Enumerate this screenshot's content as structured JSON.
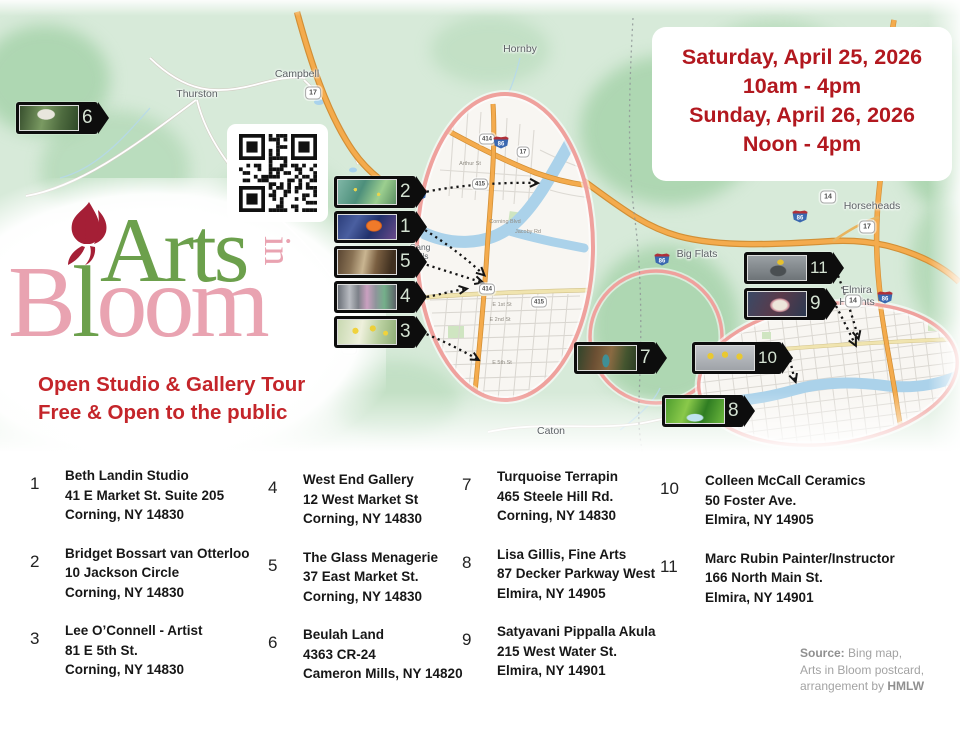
{
  "event": {
    "line1": "Saturday, April 25, 2026",
    "line2": "10am - 4pm",
    "line3": "Sunday, April 26, 2026",
    "line4": "Noon - 4pm"
  },
  "logo": {
    "arts": "Arts",
    "in": "in",
    "bloom_b": "B",
    "bloom_l": "l",
    "bloom_oom": "oom"
  },
  "tagline": {
    "line1": "Open Studio & Gallery Tour",
    "line2": "Free & Open to the public"
  },
  "map": {
    "towns": {
      "thurston": "Thurston",
      "campbell": "Campbell",
      "hornby": "Hornby",
      "caton": "Caton",
      "big_flats": "Big Flats",
      "horseheads": "Horseheads",
      "elmira_heights_line1": "Elmira",
      "elmira_heights_line2": "Heights",
      "gang_mills_line1": "Gang",
      "gang_mills_line2": "Mills"
    },
    "route_shields": [
      "17",
      "15",
      "14",
      "17",
      "14",
      "414",
      "17",
      "415",
      "414",
      "415"
    ],
    "interstate": "86",
    "streets": [
      "Arthur St",
      "Corning Blvd",
      "Jacoby Rd",
      "E 1st St",
      "E 2nd St",
      "E 5th St"
    ],
    "markers": [
      {
        "number": "1",
        "photo": "koi-fish-painting"
      },
      {
        "number": "2",
        "photo": "landscape-painting"
      },
      {
        "number": "3",
        "photo": "daffodil-painting"
      },
      {
        "number": "4",
        "photo": "gallery-storefront"
      },
      {
        "number": "5",
        "photo": "glass-horn-sculpture"
      },
      {
        "number": "6",
        "photo": "house-and-garden"
      },
      {
        "number": "7",
        "photo": "wooden-cabin"
      },
      {
        "number": "8",
        "photo": "green-landscape-painting"
      },
      {
        "number": "9",
        "photo": "lily-flower"
      },
      {
        "number": "10",
        "photo": "daffodils-in-vases"
      },
      {
        "number": "11",
        "photo": "sculpture-with-lemon"
      }
    ]
  },
  "directory": {
    "entries": [
      {
        "num": "1",
        "name": "Beth Landin Studio",
        "address": "41 E Market St. Suite 205",
        "city": "Corning, NY 14830"
      },
      {
        "num": "2",
        "name": "Bridget Bossart van Otterloo",
        "address": "10 Jackson Circle",
        "city": "Corning, NY 14830"
      },
      {
        "num": "3",
        "name": "Lee O’Connell - Artist",
        "address": "81 E 5th St.",
        "city": "Corning, NY 14830"
      },
      {
        "num": "4",
        "name": "West End Gallery",
        "address": "12 West Market St",
        "city": "Corning, NY 14830"
      },
      {
        "num": "5",
        "name": "The Glass Menagerie",
        "address": "37 East Market St.",
        "city": "Corning, NY 14830"
      },
      {
        "num": "6",
        "name": "Beulah Land",
        "address": "4363 CR-24",
        "city": "Cameron  Mills, NY 14820"
      },
      {
        "num": "7",
        "name": "Turquoise Terrapin",
        "address": "465 Steele Hill Rd.",
        "city": "Corning, NY 14830"
      },
      {
        "num": "8",
        "name": "Lisa Gillis, Fine Arts",
        "address": "87 Decker Parkway West",
        "city": "Elmira, NY 14905"
      },
      {
        "num": "9",
        "name": "Satyavani Pippalla Akula",
        "address": "215 West Water St.",
        "city": "Elmira, NY 14901"
      },
      {
        "num": "10",
        "name": "Colleen McCall Ceramics",
        "address": "50 Foster Ave.",
        "city": "Elmira, NY 14905"
      },
      {
        "num": "11",
        "name": "Marc Rubin Painter/Instructor",
        "address": "166 North Main St.",
        "city": "Elmira, NY 14901"
      }
    ]
  },
  "source_note": {
    "label": "Source:",
    "rest1": " Bing map,",
    "line2": "Arts in Bloom postcard,",
    "line3a": "arrangement by ",
    "line3b": "HMLW"
  }
}
